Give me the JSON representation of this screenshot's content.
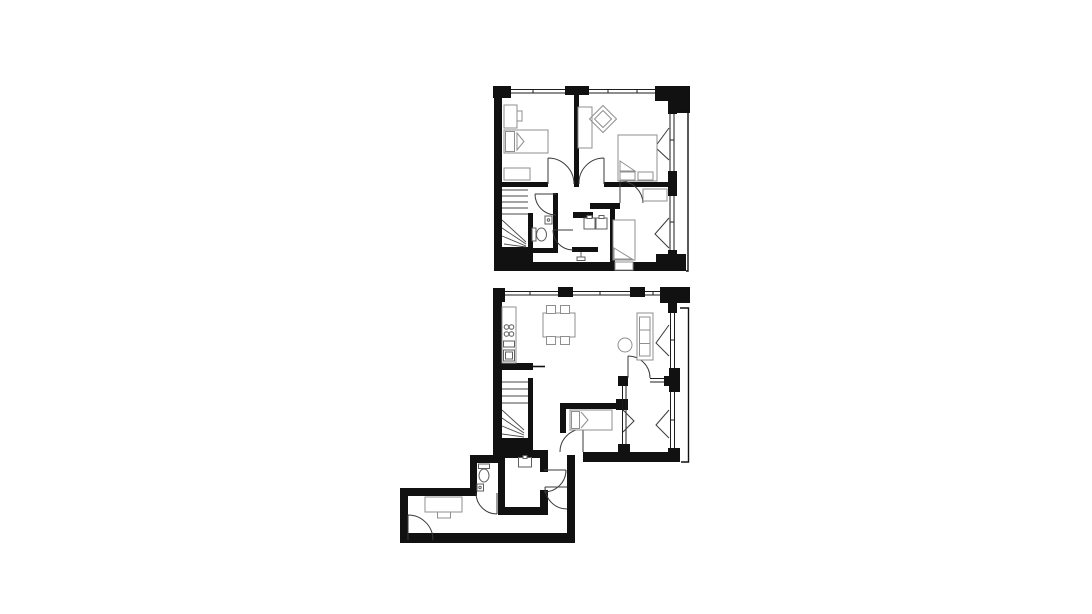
{
  "page": {
    "background": "#ffffff"
  },
  "colors": {
    "background": "#ffffff",
    "wall": "#111111",
    "glass": "#1c1c1c",
    "door": "#3a3a3a",
    "stair": "#4a4a4a",
    "furniture": "#8f8f8f",
    "fixture": "#5f5f5f"
  },
  "drawing": {
    "type": "architectural-floor-plan",
    "text_labels": [],
    "floors": [
      {
        "name": "upper-floor",
        "rooms": [
          "bedroom-left",
          "bedroom-right",
          "bedroom-small",
          "bathroom",
          "wc",
          "hallway",
          "staircase"
        ],
        "furniture": [
          "desk",
          "desk-chair",
          "single-bed",
          "dresser",
          "wardrobe",
          "armchair",
          "double-bed",
          "toilet",
          "hand-basin",
          "double-sink-vanity",
          "shower",
          "single-bed",
          "foot-dresser"
        ]
      },
      {
        "name": "lower-floor",
        "rooms": [
          "kitchen-living-room",
          "bedroom",
          "glazed-loggia",
          "stair-hall",
          "wc",
          "storage-room",
          "entrance-corridor"
        ],
        "furniture": [
          "kitchen-counter",
          "stove",
          "kitchen-sink",
          "dining-table",
          "four-chairs",
          "sofa",
          "round-side-table",
          "single-bed",
          "toilet",
          "hand-basin",
          "wall-sink",
          "desk",
          "desk-chair"
        ]
      }
    ]
  }
}
